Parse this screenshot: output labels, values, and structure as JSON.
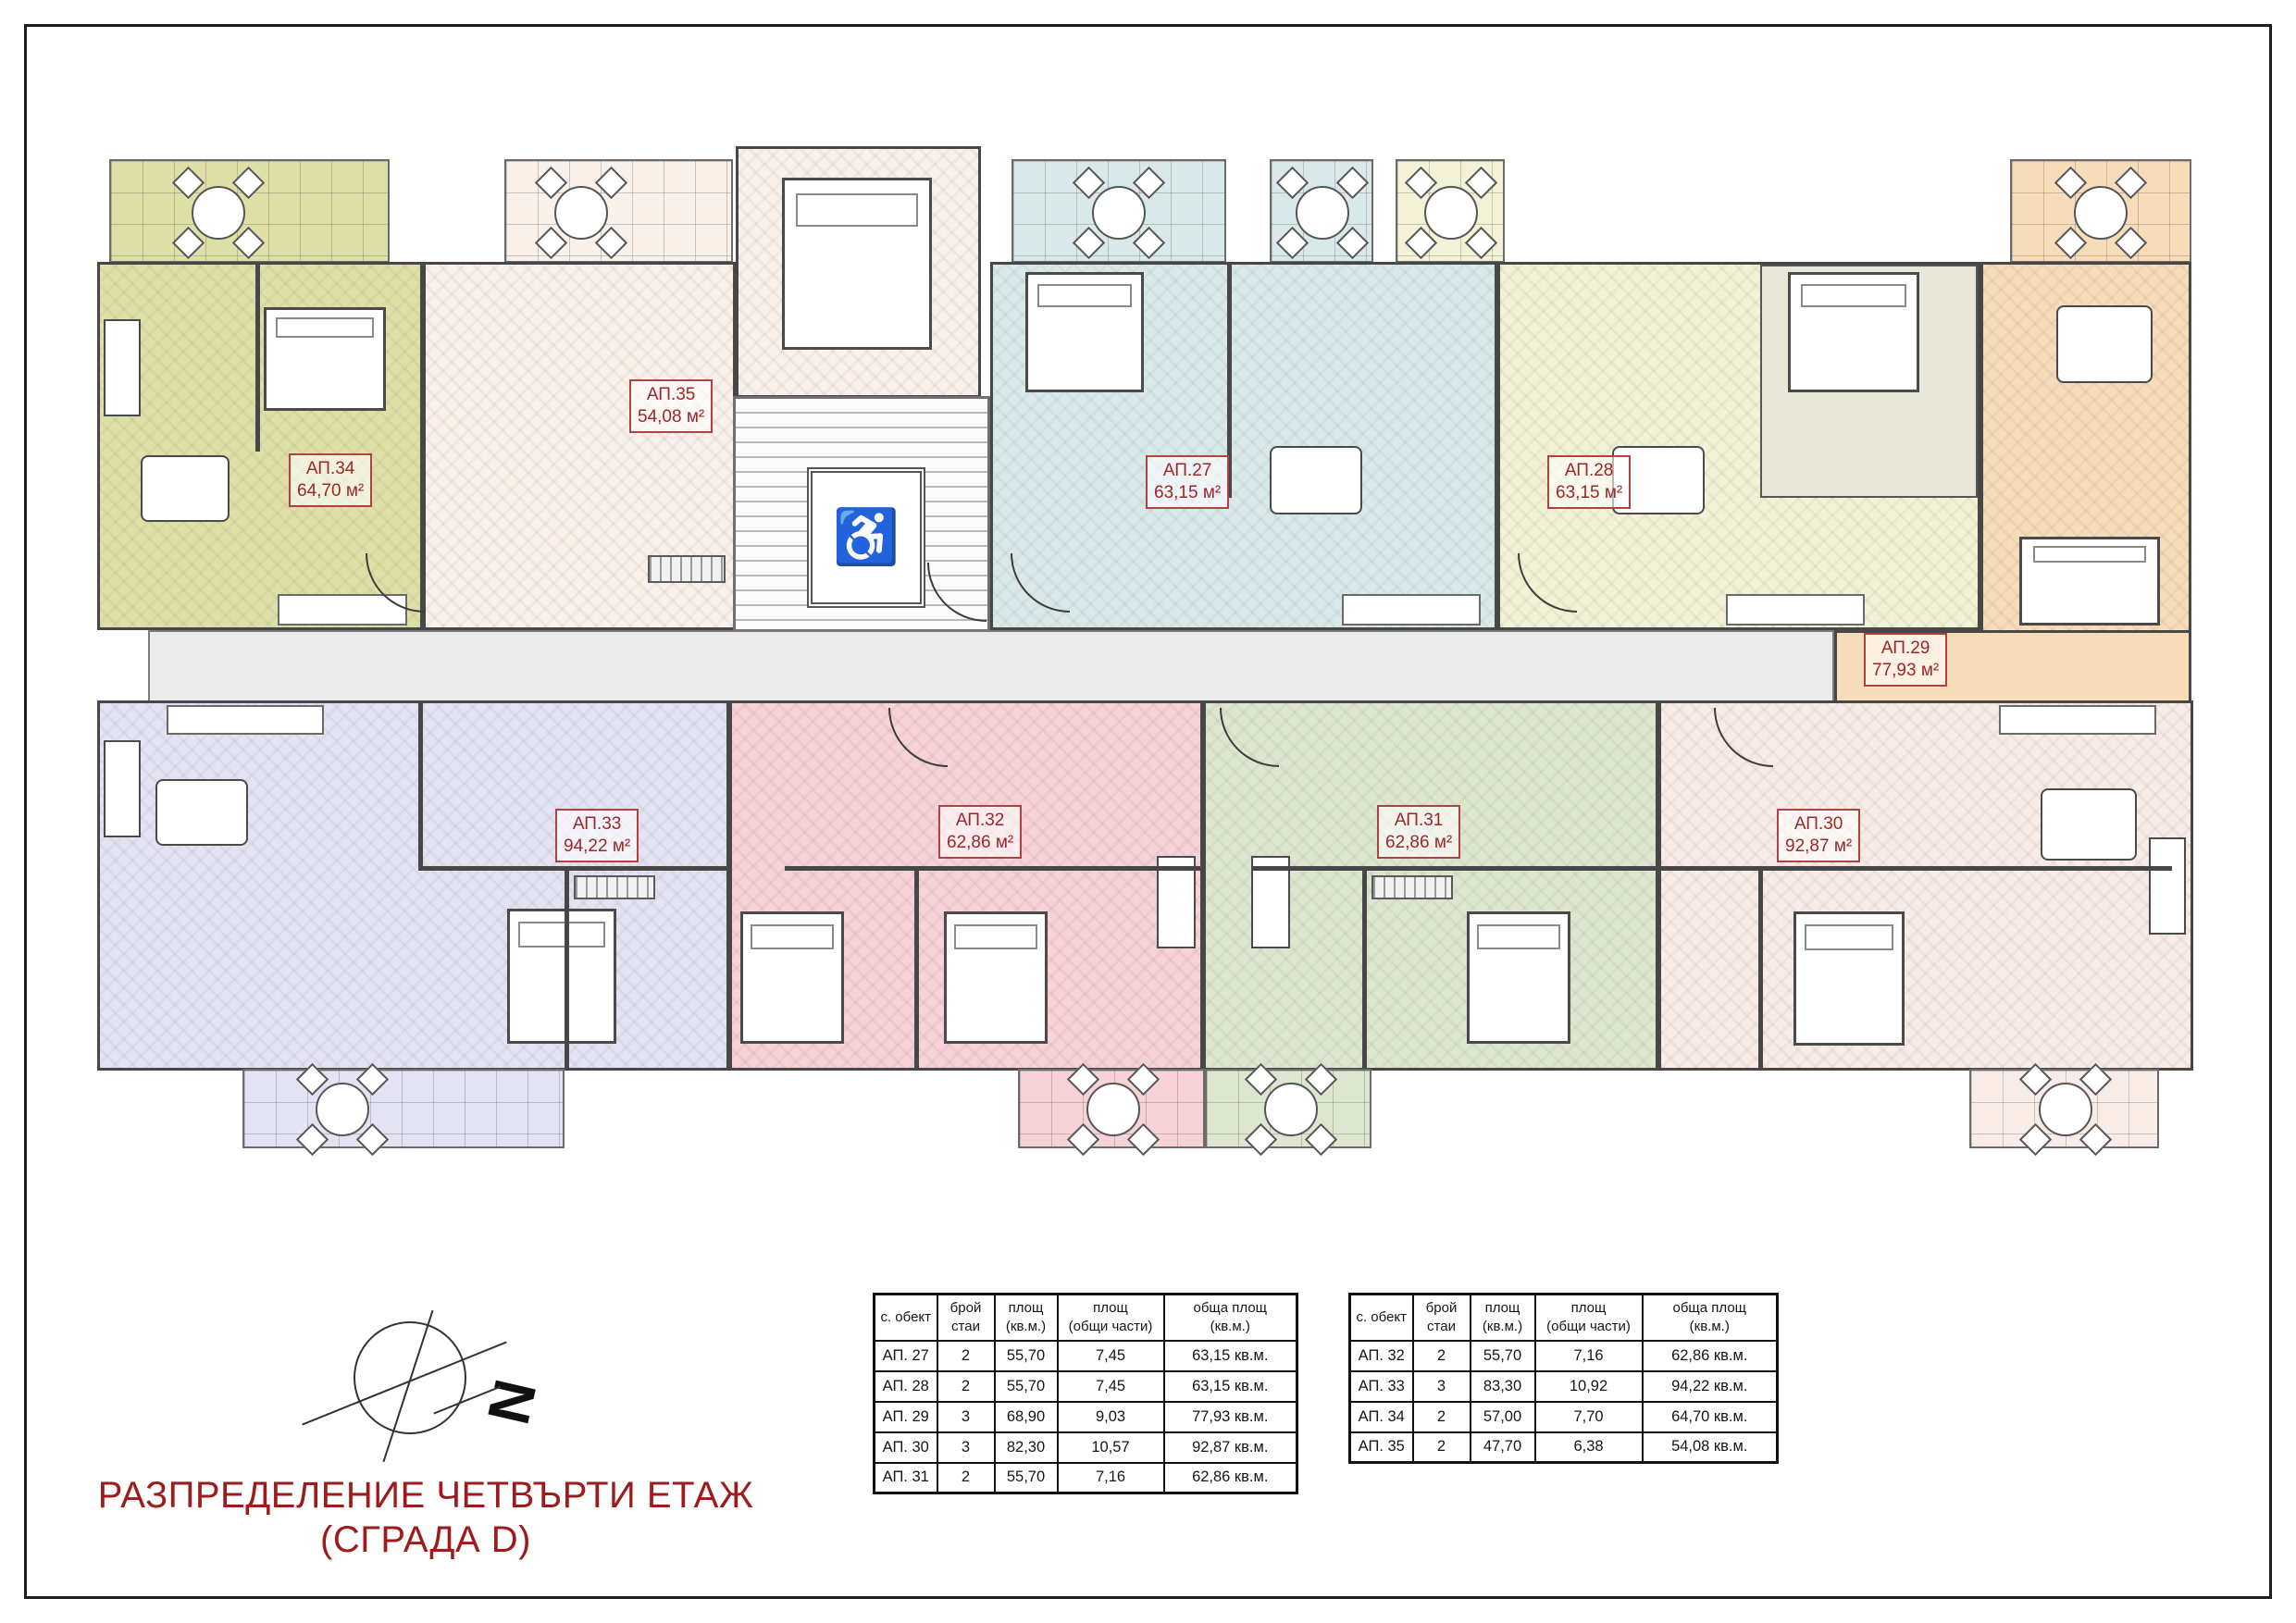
{
  "page": {
    "title_line1": "РАЗПРЕДЕЛЕНИЕ ЧЕТВЪРТИ ЕТАЖ",
    "title_line2": "(СГРАДА D)"
  },
  "compass": {
    "north_label": "N"
  },
  "plan": {
    "elevator_icon": "♿"
  },
  "colors": {
    "accent_red": "#9e1b1b",
    "label_border_red": "#b04341",
    "ap27": "#d9e9ea",
    "ap28": "#f3f2d6",
    "ap29": "#f7dcba",
    "ap30": "#f9ece7",
    "ap31": "#dde7d0",
    "ap32": "#f7d2d7",
    "ap33": "#e3e3f3",
    "ap34": "#dfe0a8",
    "ap35": "#faf1ea"
  },
  "apartments": [
    {
      "id": "АП.27",
      "area": "63,15 м²"
    },
    {
      "id": "АП.28",
      "area": "63,15 м²"
    },
    {
      "id": "АП.29",
      "area": "77,93 м²"
    },
    {
      "id": "АП.30",
      "area": "92,87 м²"
    },
    {
      "id": "АП.31",
      "area": "62,86 м²"
    },
    {
      "id": "АП.32",
      "area": "62,86 м²"
    },
    {
      "id": "АП.33",
      "area": "94,22 м²"
    },
    {
      "id": "АП.34",
      "area": "64,70 м²"
    },
    {
      "id": "АП.35",
      "area": "54,08 м²"
    }
  ],
  "tables": [
    {
      "headers": [
        "с. обект",
        "брой\nстаи",
        "площ\n(кв.м.)",
        "площ\n(общи части)",
        "обща площ\n(кв.м.)"
      ],
      "rows": [
        [
          "АП. 27",
          "2",
          "55,70",
          "7,45",
          "63,15 кв.м."
        ],
        [
          "АП. 28",
          "2",
          "55,70",
          "7,45",
          "63,15 кв.м."
        ],
        [
          "АП. 29",
          "3",
          "68,90",
          "9,03",
          "77,93 кв.м."
        ],
        [
          "АП. 30",
          "3",
          "82,30",
          "10,57",
          "92,87 кв.м."
        ],
        [
          "АП. 31",
          "2",
          "55,70",
          "7,16",
          "62,86 кв.м."
        ]
      ]
    },
    {
      "headers": [
        "с. обект",
        "брой\nстаи",
        "площ\n(кв.м.)",
        "площ\n(общи части)",
        "обща площ\n(кв.м.)"
      ],
      "rows": [
        [
          "АП. 32",
          "2",
          "55,70",
          "7,16",
          "62,86 кв.м."
        ],
        [
          "АП. 33",
          "3",
          "83,30",
          "10,92",
          "94,22 кв.м."
        ],
        [
          "АП. 34",
          "2",
          "57,00",
          "7,70",
          "64,70 кв.м."
        ],
        [
          "АП. 35",
          "2",
          "47,70",
          "6,38",
          "54,08 кв.м."
        ]
      ]
    }
  ]
}
